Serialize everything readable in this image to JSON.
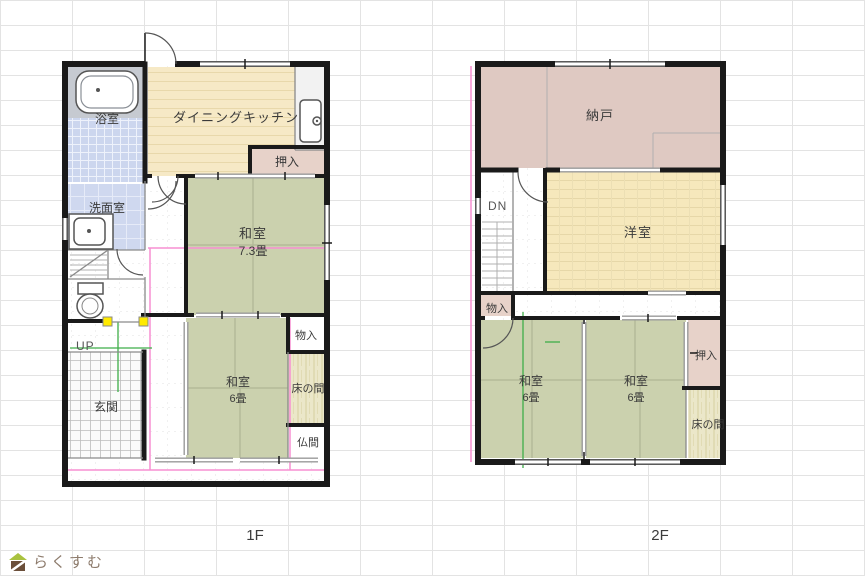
{
  "floor1": {
    "caption": "1F",
    "bath": "浴室",
    "washroom": "洗面室",
    "dining_kitchen": "ダイニングキッチン",
    "oshiire": "押入",
    "washitsu_main": "和室",
    "washitsu_main_size": "7.3畳",
    "monoire": "物入",
    "tokonoma": "床の間",
    "washitsu_sub": "和室",
    "washitsu_sub_size": "6畳",
    "butsuma": "仏間",
    "genkan": "玄関",
    "stairs": "UP"
  },
  "floor2": {
    "caption": "2F",
    "nando": "納戸",
    "stairs": "DN",
    "youshitsu": "洋室",
    "monoire": "物入",
    "washitsu_a": "和室",
    "washitsu_a_size": "6畳",
    "washitsu_b": "和室",
    "washitsu_b_size": "6畳",
    "oshiire": "押入",
    "tokonoma": "床の間"
  },
  "logo": {
    "text": "らくすむ"
  },
  "colors": {
    "tatami": "#cbd1ae",
    "wood_floor": "#f6e9c6",
    "bath_tile": "#ccd6ee",
    "closet_pink": "#e7d2c9",
    "nando_pink": "#dfc9c2",
    "youshitsu_floor": "#f6e8bc",
    "tokonoma_floor": "#ebe7c9",
    "wall": "#1a1a1a",
    "accent_pink": "#f78fd2",
    "accent_green": "#3fae49",
    "marker_yellow": "#ffea00"
  }
}
